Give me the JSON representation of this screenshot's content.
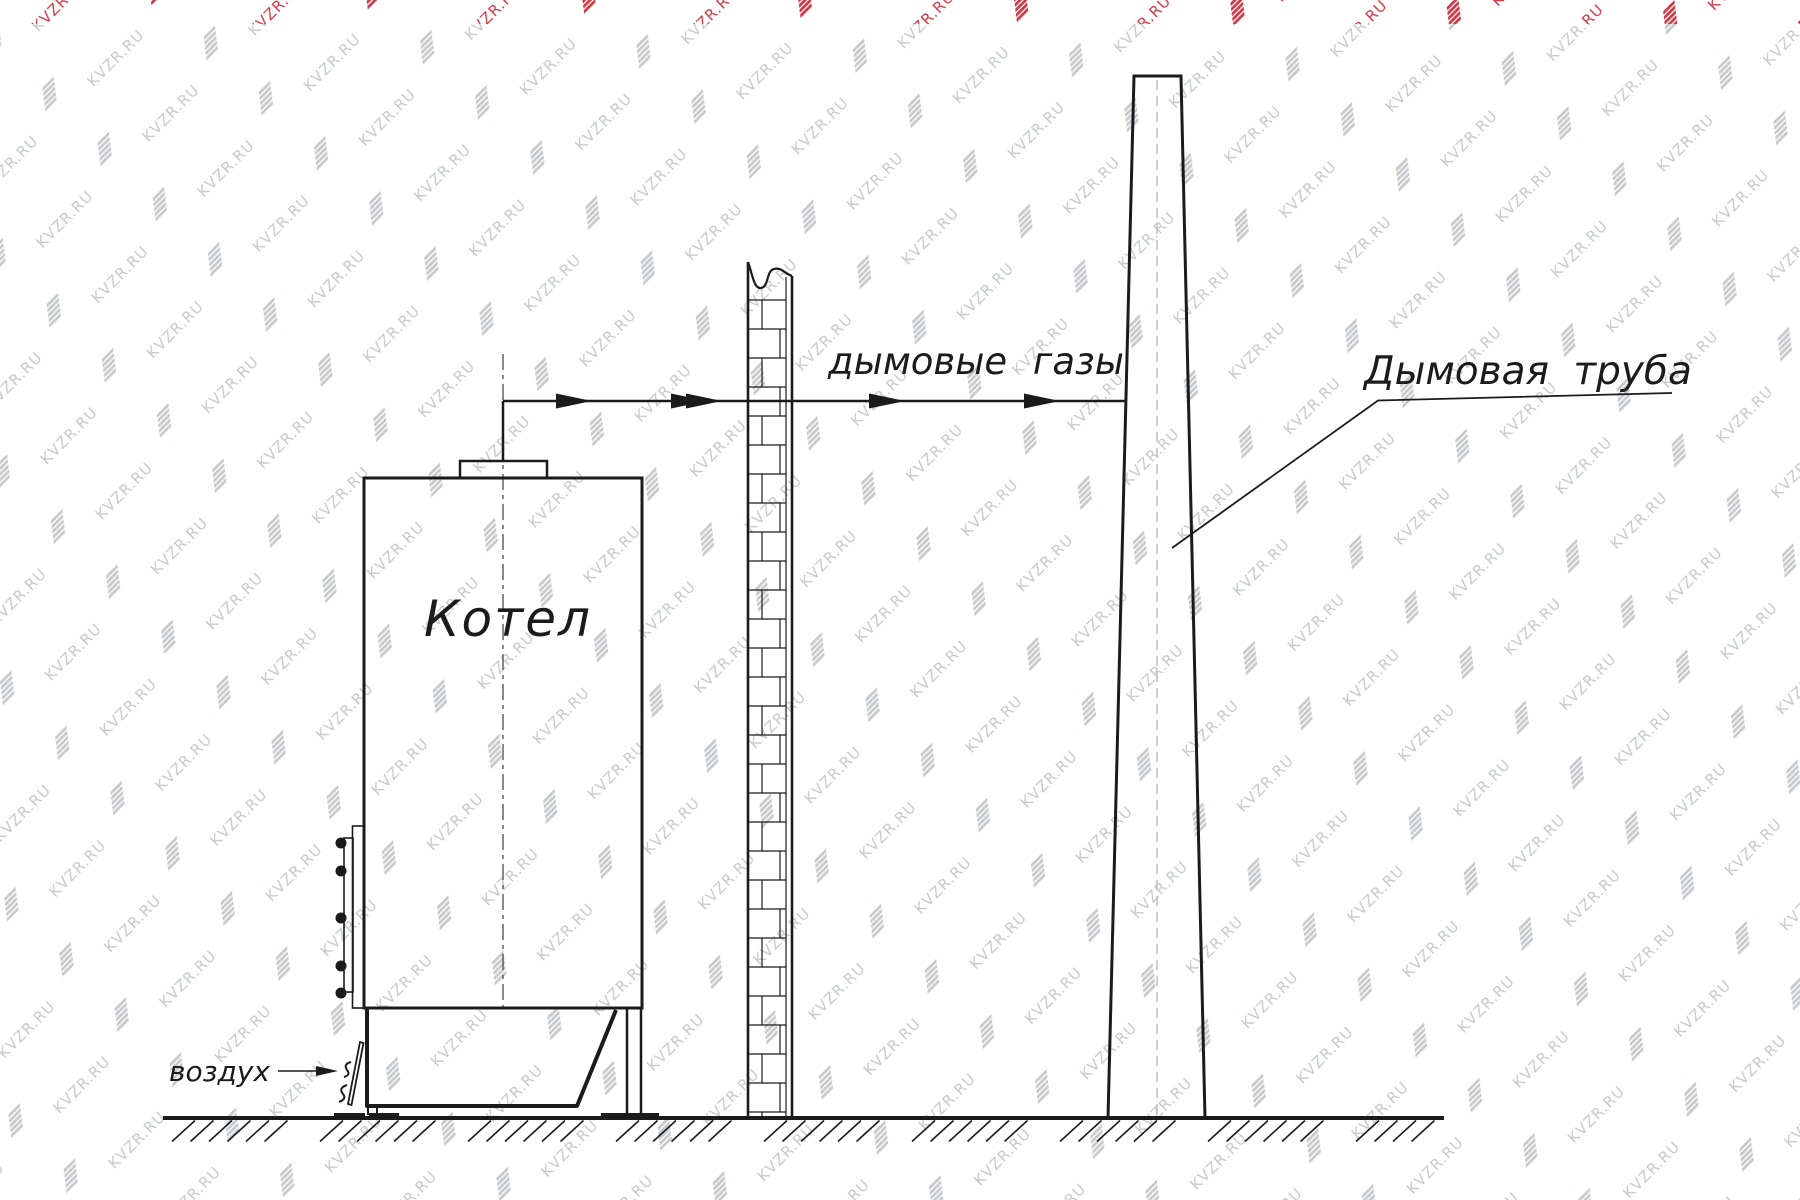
{
  "watermark": {
    "text": "KVZR.RU",
    "color_gray": "#c6c9cd",
    "color_red": "#cd3a45"
  },
  "labels": {
    "boiler": "Котел",
    "flue_gases": "дымовые газы",
    "chimney": "Дымовая труба",
    "air": "воздух"
  },
  "colors": {
    "line": "#1b1b1b",
    "centerline_dark": "#4a4a4a",
    "centerline_light": "#b8b8b8"
  }
}
